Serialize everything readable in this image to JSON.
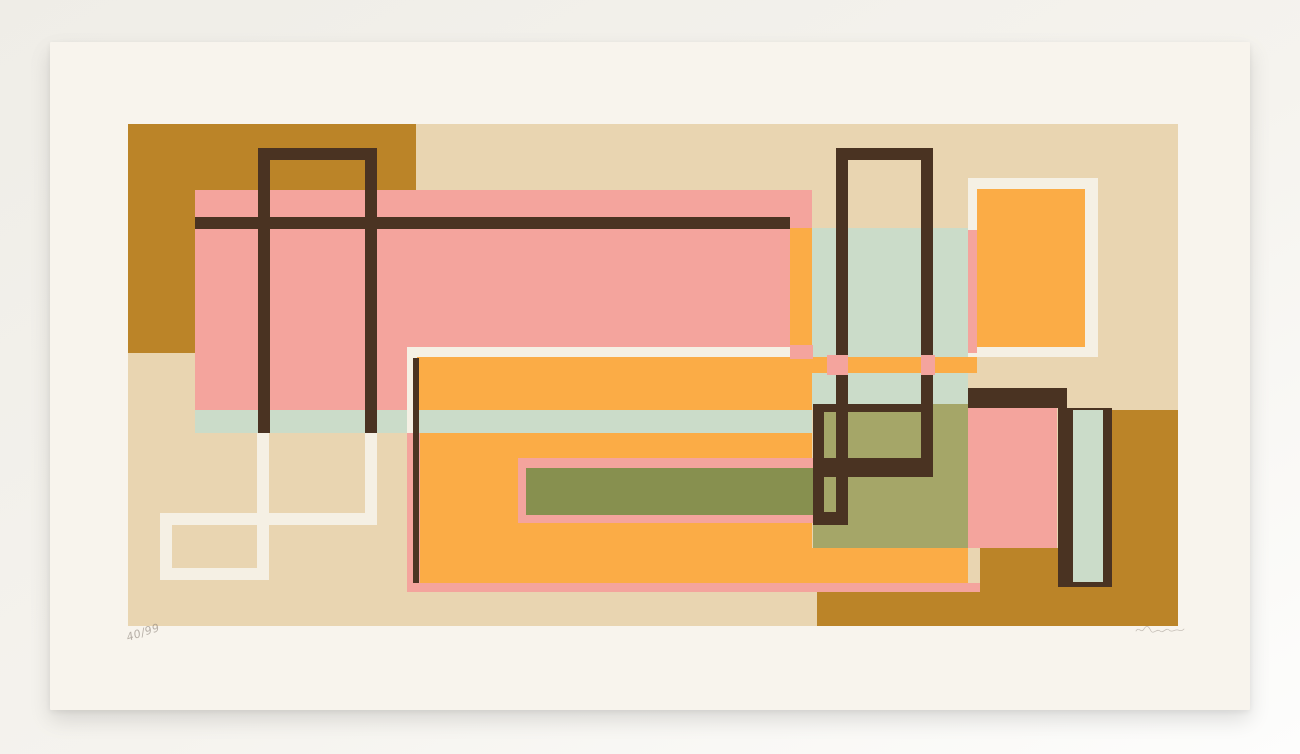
{
  "artwork": {
    "type": "abstract geometric serigraph print, photographed on a light backdrop",
    "edition_number": "40/99",
    "signature": "illegible pencil signature"
  },
  "palette": {
    "backdrop": "#efede7",
    "backdrop_mid": "#f5f3ee",
    "backdrop_light": "#fdfdfc",
    "paper": "#f8f4ed",
    "beige": "#e9d5b1",
    "mustard": "#bb8428",
    "pink": "#f4a49d",
    "orange": "#fbac46",
    "mint": "#cbdcc9",
    "olive_dark": "#87904f",
    "olive_light": "#a5a668",
    "brown": "#4a3322",
    "white_ink": "#f5f0e4",
    "pencil": "#8b8178"
  },
  "print": {
    "shapes": [
      {
        "n": "print-background",
        "x": 0,
        "y": 0,
        "w": 1050,
        "h": 502,
        "c": "beige"
      },
      {
        "n": "mustard-block-top-left",
        "x": 0,
        "y": 0,
        "w": 288,
        "h": 229,
        "c": "mustard"
      },
      {
        "n": "pink-field-main",
        "x": 67,
        "y": 66,
        "w": 617,
        "h": 222,
        "c": "pink"
      },
      {
        "n": "orange-strip-vertical",
        "x": 662,
        "y": 104,
        "w": 22,
        "h": 119,
        "c": "orange"
      },
      {
        "n": "mint-field-upper-right",
        "x": 684,
        "y": 104,
        "w": 156,
        "h": 130,
        "c": "mint"
      },
      {
        "n": "mint-field-lower-right",
        "x": 684,
        "y": 249,
        "w": 156,
        "h": 34,
        "c": "mint"
      },
      {
        "n": "orange-band-right",
        "x": 684,
        "y": 233,
        "w": 165,
        "h": 16,
        "c": "orange"
      },
      {
        "n": "olive-field-right",
        "x": 685,
        "y": 280,
        "w": 155,
        "h": 144,
        "c": "olive_light"
      },
      {
        "n": "orange-field-main",
        "x": 289,
        "y": 233,
        "w": 395,
        "h": 226,
        "c": "orange"
      },
      {
        "n": "orange-field-extension",
        "x": 684,
        "y": 424,
        "w": 156,
        "h": 37,
        "c": "orange"
      },
      {
        "n": "pink-band-bottom",
        "x": 279,
        "y": 459,
        "w": 573,
        "h": 9,
        "c": "pink"
      },
      {
        "n": "pink-frame-olive-bar",
        "x": 390,
        "y": 334,
        "w": 295,
        "h": 65,
        "c": "pink"
      },
      {
        "n": "olive-bar",
        "x": 398,
        "y": 344,
        "w": 287,
        "h": 47,
        "c": "olive_dark"
      },
      {
        "n": "mint-band-center",
        "x": 67,
        "y": 286,
        "w": 617,
        "h": 23,
        "c": "mint"
      },
      {
        "n": "white-line-left-vertical",
        "x": 32,
        "y": 389,
        "w": 12,
        "h": 67,
        "c": "white_ink"
      },
      {
        "n": "white-line-bottom",
        "x": 32,
        "y": 444,
        "w": 108,
        "h": 12,
        "c": "white_ink"
      },
      {
        "n": "white-line-mid-vertical",
        "x": 129,
        "y": 309,
        "w": 12,
        "h": 147,
        "c": "white_ink"
      },
      {
        "n": "white-line-right-vertical",
        "x": 237,
        "y": 309,
        "w": 12,
        "h": 92,
        "c": "white_ink"
      },
      {
        "n": "white-line-horizontal",
        "x": 32,
        "y": 389,
        "w": 217,
        "h": 12,
        "c": "white_ink"
      },
      {
        "n": "white-border-top",
        "x": 279,
        "y": 223,
        "w": 383,
        "h": 10,
        "c": "white_ink"
      },
      {
        "n": "white-border-left",
        "x": 279,
        "y": 223,
        "w": 10,
        "h": 86,
        "c": "white_ink"
      },
      {
        "n": "pink-corner-rect",
        "x": 662,
        "y": 221,
        "w": 23,
        "h": 14,
        "c": "pink"
      },
      {
        "n": "pink-border-left",
        "x": 279,
        "y": 309,
        "w": 13,
        "h": 159,
        "c": "pink"
      },
      {
        "n": "brown-inner-edge-line",
        "x": 285,
        "y": 234,
        "w": 6,
        "h": 225,
        "c": "brown"
      },
      {
        "n": "brown-frame-left-top",
        "x": 130,
        "y": 24,
        "w": 119,
        "h": 12,
        "c": "brown"
      },
      {
        "n": "brown-frame-left-v1",
        "x": 130,
        "y": 24,
        "w": 12,
        "h": 285,
        "c": "brown"
      },
      {
        "n": "brown-frame-left-v2",
        "x": 237,
        "y": 24,
        "w": 12,
        "h": 285,
        "c": "brown"
      },
      {
        "n": "brown-crossbar-long",
        "x": 67,
        "y": 93,
        "w": 595,
        "h": 12,
        "c": "brown"
      },
      {
        "n": "brown-frame-right-top",
        "x": 708,
        "y": 24,
        "w": 97,
        "h": 12,
        "c": "brown"
      },
      {
        "n": "brown-frame-right-v1",
        "x": 708,
        "y": 24,
        "w": 12,
        "h": 375,
        "c": "brown"
      },
      {
        "n": "brown-frame-right-v2",
        "x": 793,
        "y": 24,
        "w": 12,
        "h": 322,
        "c": "brown"
      },
      {
        "n": "brown-ledge-top",
        "x": 685,
        "y": 280,
        "w": 120,
        "h": 8,
        "c": "brown"
      },
      {
        "n": "brown-ledge-mid",
        "x": 685,
        "y": 334,
        "w": 120,
        "h": 19,
        "c": "brown"
      },
      {
        "n": "brown-ledge-bottom",
        "x": 685,
        "y": 388,
        "w": 35,
        "h": 13,
        "c": "brown"
      },
      {
        "n": "brown-frame-right-v3",
        "x": 685,
        "y": 280,
        "w": 11,
        "h": 121,
        "c": "brown"
      },
      {
        "n": "pink-crossing-left",
        "x": 699,
        "y": 231,
        "w": 21,
        "h": 20,
        "c": "pink"
      },
      {
        "n": "pink-crossing-right",
        "x": 793,
        "y": 231,
        "w": 14,
        "h": 20,
        "c": "pink"
      },
      {
        "n": "white-frame-top-right",
        "x": 840,
        "y": 54,
        "w": 130,
        "h": 179,
        "c": "white_ink"
      },
      {
        "n": "orange-block-top-right",
        "x": 849,
        "y": 65,
        "w": 108,
        "h": 158,
        "c": "orange"
      },
      {
        "n": "pink-edge-strip",
        "x": 840,
        "y": 106,
        "w": 9,
        "h": 123,
        "c": "pink"
      },
      {
        "n": "brown-band-right",
        "x": 840,
        "y": 264,
        "w": 99,
        "h": 20,
        "c": "brown"
      },
      {
        "n": "pink-block-right",
        "x": 840,
        "y": 284,
        "w": 89,
        "h": 140,
        "c": "pink"
      },
      {
        "n": "mustard-column-right",
        "x": 982,
        "y": 286,
        "w": 68,
        "h": 216,
        "c": "mustard"
      },
      {
        "n": "mustard-block-bottom-right",
        "x": 852,
        "y": 424,
        "w": 198,
        "h": 78,
        "c": "mustard"
      },
      {
        "n": "mustard-strip-bottom",
        "x": 689,
        "y": 468,
        "w": 361,
        "h": 34,
        "c": "mustard"
      },
      {
        "n": "brown-bar-vertical",
        "x": 930,
        "y": 284,
        "w": 54,
        "h": 179,
        "c": "brown"
      },
      {
        "n": "mint-bar-vertical",
        "x": 945,
        "y": 286,
        "w": 30,
        "h": 172,
        "c": "mint"
      }
    ]
  }
}
